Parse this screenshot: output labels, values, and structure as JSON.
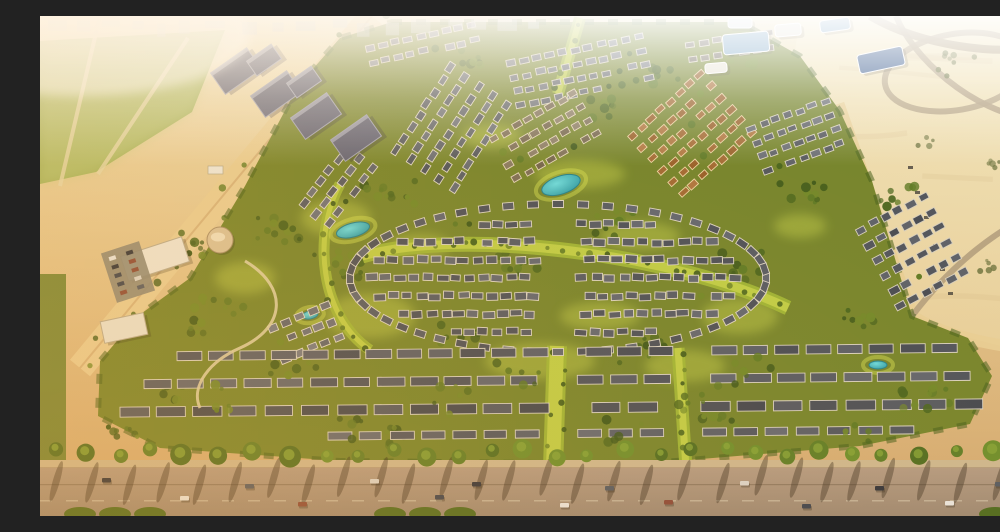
{
  "meta": {
    "description": "Golden-hour aerial rendering of a desert master-planned villa community: dense rows of white villas with dark and terracotta roofs set in green parks with turquoise ponds, a large oval villa cluster at the center, mid-rise apartment blocks and a green field to the northwest, blue glass buildings and open desert with looping sand roads to the east, and a palm-lined boulevard road with cars across the foreground."
  },
  "palette": {
    "sand_top": "#efe1b5",
    "sand_mid": "#e2c58e",
    "sand_bottom": "#d2a86f",
    "desert_light": "#f3e6bd",
    "desert_deep": "#e7d09c",
    "field_green": "#a3b45f",
    "field_light": "#c3cd81",
    "community_green": "#75852d",
    "green_dark": "#3f5a1c",
    "green_mid": "#5e7a26",
    "green_bright": "#9fb637",
    "green_highlight": "#cdd94f",
    "edge_trees": "#46601e",
    "road_top": "#b39b83",
    "road_bottom": "#9d8973",
    "sidewalk": "#cdb890",
    "sand_road": "#e8cf97",
    "desert_road": "#b3a080",
    "roof_gray": "#565b64",
    "roof_dark": "#474c55",
    "roof_brown": "#a26a34",
    "wall_white": "#ddd7c7",
    "wall_cream": "#ecd3a2",
    "apartment": "#5e6176",
    "apartment_light": "#9fa2b4",
    "glass_blue": "#7fa8c8",
    "panel_navy": "#3f5f90",
    "white_bldg": "#e9e6da",
    "pond": "#3fc3cf",
    "pond_deep": "#2a9aa6",
    "pond_rim": "#22808c",
    "shadow": "rgba(50,40,25,0.38)",
    "skyline": "#c2c8ce",
    "palm_greens": [
      "#4f6e22",
      "#5e7e28",
      "#6d8f2d"
    ],
    "tree_greens": [
      "#3f5a1c",
      "#4a661f",
      "#5e7a26",
      "#71892a"
    ],
    "desert_tree": "#6d7440",
    "car_colors": [
      "#30343c",
      "#e8e6e0",
      "#555b64",
      "#8a4a3a",
      "#d9d5cc",
      "#3d4450"
    ]
  },
  "scene": {
    "seed": 42,
    "field": {
      "poly": "0,25 185,14 152,96 56,156 0,168",
      "roads": [
        "M60,0 L20,170",
        "M148,22 L58,158"
      ],
      "buildings": [
        {
          "x": 168,
          "y": 150,
          "w": 15,
          "h": 8
        },
        {
          "x": 186,
          "y": 157,
          "w": 12,
          "h": 7
        },
        {
          "x": 204,
          "y": 150,
          "w": 10,
          "h": 6
        }
      ]
    },
    "desert_right_poly": "760,0 1000,0 1000,340 930,322 868,296 828,160 793,90 755,35",
    "left_road": {
      "d": "M332,0 L40,352",
      "w": 26
    },
    "community_poly": "352,6 700,6 760,40 800,95 832,165 872,300 928,322 952,360 930,408 820,430 600,448 300,445 120,432 58,400 60,345 98,300 150,262 205,170 258,70 300,22",
    "left_strip": {
      "x": 0,
      "y": 258,
      "w": 26,
      "h": 190
    },
    "highlights": [
      {
        "x": 330,
        "y": 300,
        "rx": 45,
        "ry": 22
      },
      {
        "x": 500,
        "y": 345,
        "rx": 55,
        "ry": 18
      },
      {
        "x": 645,
        "y": 350,
        "rx": 40,
        "ry": 16
      },
      {
        "x": 296,
        "y": 202,
        "rx": 35,
        "ry": 18
      },
      {
        "x": 540,
        "y": 158,
        "rx": 45,
        "ry": 14
      },
      {
        "x": 700,
        "y": 300,
        "rx": 38,
        "ry": 18
      },
      {
        "x": 205,
        "y": 262,
        "rx": 30,
        "ry": 16
      },
      {
        "x": 452,
        "y": 120,
        "rx": 30,
        "ry": 12
      },
      {
        "x": 600,
        "y": 220,
        "rx": 40,
        "ry": 14
      },
      {
        "x": 380,
        "y": 230,
        "rx": 30,
        "ry": 12
      },
      {
        "x": 760,
        "y": 210,
        "rx": 26,
        "ry": 12
      },
      {
        "x": 560,
        "y": 300,
        "rx": 40,
        "ry": 14
      }
    ],
    "scatter": [
      {
        "x": 350,
        "y": 180,
        "n": 12,
        "s": 26
      },
      {
        "x": 300,
        "y": 250,
        "n": 12,
        "s": 28
      },
      {
        "x": 420,
        "y": 322,
        "n": 12,
        "s": 26
      },
      {
        "x": 600,
        "y": 330,
        "n": 12,
        "s": 28
      },
      {
        "x": 700,
        "y": 250,
        "n": 12,
        "s": 26
      },
      {
        "x": 762,
        "y": 180,
        "n": 10,
        "s": 22
      },
      {
        "x": 570,
        "y": 210,
        "n": 10,
        "s": 24
      },
      {
        "x": 480,
        "y": 250,
        "n": 10,
        "s": 22
      },
      {
        "x": 240,
        "y": 212,
        "n": 12,
        "s": 24
      },
      {
        "x": 180,
        "y": 300,
        "n": 14,
        "s": 30
      },
      {
        "x": 130,
        "y": 380,
        "n": 10,
        "s": 22
      },
      {
        "x": 858,
        "y": 180,
        "n": 8,
        "s": 18
      },
      {
        "x": 820,
        "y": 300,
        "n": 8,
        "s": 18
      },
      {
        "x": 560,
        "y": 92,
        "n": 8,
        "s": 18
      },
      {
        "x": 622,
        "y": 60,
        "n": 8,
        "s": 16
      },
      {
        "x": 430,
        "y": 42,
        "n": 7,
        "s": 14
      },
      {
        "x": 700,
        "y": 42,
        "n": 7,
        "s": 14
      },
      {
        "x": 898,
        "y": 380,
        "n": 8,
        "s": 18
      },
      {
        "x": 82,
        "y": 420,
        "n": 8,
        "s": 16
      },
      {
        "x": 352,
        "y": 420,
        "n": 8,
        "s": 18
      },
      {
        "x": 680,
        "y": 402,
        "n": 8,
        "s": 18
      },
      {
        "x": 150,
        "y": 238,
        "n": 10,
        "s": 22
      }
    ],
    "fore_scatter": [
      {
        "x": 250,
        "y": 356,
        "n": 6,
        "s": 26
      },
      {
        "x": 480,
        "y": 356,
        "n": 6,
        "s": 26
      },
      {
        "x": 720,
        "y": 356,
        "n": 6,
        "s": 26
      },
      {
        "x": 180,
        "y": 384,
        "n": 6,
        "s": 26
      },
      {
        "x": 420,
        "y": 384,
        "n": 6,
        "s": 26
      },
      {
        "x": 660,
        "y": 384,
        "n": 6,
        "s": 26
      },
      {
        "x": 880,
        "y": 384,
        "n": 5,
        "s": 20
      },
      {
        "x": 320,
        "y": 412,
        "n": 5,
        "s": 24
      },
      {
        "x": 580,
        "y": 412,
        "n": 5,
        "s": 24
      },
      {
        "x": 820,
        "y": 412,
        "n": 5,
        "s": 22
      }
    ],
    "desert_scatter": [
      {
        "x": 918,
        "y": 48,
        "n": 8,
        "s": 20
      },
      {
        "x": 955,
        "y": 150,
        "n": 5,
        "s": 12
      },
      {
        "x": 885,
        "y": 125,
        "n": 4,
        "s": 10
      },
      {
        "x": 940,
        "y": 252,
        "n": 5,
        "s": 14
      },
      {
        "x": 762,
        "y": 142,
        "n": 4,
        "s": 10
      },
      {
        "x": 975,
        "y": 210,
        "n": 4,
        "s": 10
      }
    ],
    "boulevards": [
      {
        "d": "M322,240 C420,212 630,236 748,292",
        "w": 15
      },
      {
        "d": "M517,330 L513,452",
        "w": 20
      },
      {
        "d": "M638,332 L646,452",
        "w": 13
      },
      {
        "d": "M540,2 L518,78",
        "w": 12
      },
      {
        "d": "M300,168 C272,220 280,300 330,334",
        "w": 11
      }
    ],
    "ponds": [
      {
        "x": 313,
        "y": 214,
        "rx": 17,
        "ry": 7,
        "rot": -15
      },
      {
        "x": 521,
        "y": 169,
        "rx": 20,
        "ry": 9,
        "rot": -18
      },
      {
        "x": 838,
        "y": 349,
        "rx": 9,
        "ry": 4,
        "rot": 0
      },
      {
        "x": 270,
        "y": 299,
        "rx": 8,
        "ry": 4,
        "rot": -10
      }
    ],
    "clusters": [
      {
        "x": 412,
        "y": 112,
        "rot": -57,
        "rows": 5,
        "cols": 8,
        "cw": 10,
        "ch": 6.5,
        "gx": 4,
        "gy": 10.5,
        "roof": "#5a6068",
        "wall": "#ded8c8"
      },
      {
        "x": 540,
        "y": 55,
        "rot": -12,
        "rows": 4,
        "cols": 11,
        "cw": 9,
        "ch": 6,
        "gx": 4,
        "gy": 8.5,
        "roof": "#676c74",
        "wall": "#d8d2c2"
      },
      {
        "x": 505,
        "y": 120,
        "rot": -30,
        "rows": 4,
        "cols": 8,
        "cw": 9,
        "ch": 6,
        "gx": 4,
        "gy": 9,
        "roof": "#7b6e58",
        "wall": "#e2d6ba"
      },
      {
        "x": 652,
        "y": 118,
        "rot": -42,
        "rows": 6,
        "cols": 8,
        "cw": 9,
        "ch": 6,
        "gx": 4,
        "gy": 9.5,
        "roof": "#a26a34",
        "wall": "#ecd3a2"
      },
      {
        "x": 756,
        "y": 120,
        "rot": -20,
        "rows": 4,
        "cols": 7,
        "cw": 9,
        "ch": 6,
        "gx": 4,
        "gy": 9,
        "roof": "#5d6168",
        "wall": "#d9d3c3"
      },
      {
        "x": 872,
        "y": 235,
        "rot": -28,
        "rows": 6,
        "cols": 6,
        "cw": 10,
        "ch": 7,
        "gx": 4,
        "gy": 10,
        "roof": "#50555e",
        "wall": "#d6d0c0"
      },
      {
        "x": 298,
        "y": 170,
        "rot": -52,
        "rows": 3,
        "cols": 6,
        "cw": 10,
        "ch": 6.5,
        "gx": 4,
        "gy": 10,
        "roof": "#62666e",
        "wall": "#dcd6c6"
      },
      {
        "x": 266,
        "y": 316,
        "rot": -22,
        "rows": 3,
        "cols": 5,
        "cw": 10,
        "ch": 7,
        "gx": 4,
        "gy": 10,
        "roof": "#6a6e76",
        "wall": "#e0dac9"
      },
      {
        "x": 382,
        "y": 28,
        "rot": -12,
        "rows": 2,
        "cols": 9,
        "cw": 9,
        "ch": 6,
        "gx": 4,
        "gy": 9,
        "roof": "#72767e",
        "wall": "#d8d2c2"
      },
      {
        "x": 690,
        "y": 30,
        "rot": -8,
        "rows": 2,
        "cols": 7,
        "cw": 9,
        "ch": 6,
        "gx": 4,
        "gy": 9,
        "roof": "#7a7266",
        "wall": "#ddd5c2"
      }
    ],
    "oval": {
      "cx": 518,
      "cy": 262,
      "w": 11,
      "h": 7,
      "ring": {
        "rx": 208,
        "ry": 74,
        "count": 52
      },
      "rows": {
        "rx": 196,
        "ry": 66,
        "dys": [
          -54,
          -36,
          -18,
          0,
          18,
          36,
          54
        ],
        "step": 14,
        "spine": [
          498,
          536
        ]
      },
      "roof": "#565b64",
      "wall": "#dcd5c5"
    },
    "strips": {
      "skips": [
        [
          500,
          532
        ],
        [
          622,
          654
        ]
      ],
      "wall": "#d8d2c2",
      "rows": [
        {
          "x1": 150,
          "y1": 340,
          "x2": 905,
          "y2": 332,
          "h": 9,
          "seg": 26,
          "gap": 5,
          "roof": "#4f545e"
        },
        {
          "x1": 118,
          "y1": 368,
          "x2": 918,
          "y2": 360,
          "h": 9,
          "seg": 28,
          "gap": 5,
          "roof": "#565b64"
        },
        {
          "x1": 95,
          "y1": 396,
          "x2": 930,
          "y2": 388,
          "h": 10,
          "seg": 30,
          "gap": 5,
          "roof": "#4b5058"
        },
        {
          "x1": 300,
          "y1": 420,
          "x2": 862,
          "y2": 414,
          "h": 8,
          "seg": 24,
          "gap": 6,
          "roof": "#5a5f68"
        }
      ]
    },
    "clubhouse": {
      "bldgs": [
        {
          "x": 115,
          "y": 243,
          "w": 64,
          "h": 26,
          "rot": -18,
          "fill": "#ece7d8"
        },
        {
          "x": 84,
          "y": 312,
          "w": 44,
          "h": 22,
          "rot": -12,
          "fill": "#e9e4d4"
        }
      ],
      "drum": {
        "x": 180,
        "y": 224,
        "r": 13
      },
      "parking": {
        "x": 88,
        "y": 256,
        "w": 40,
        "h": 52,
        "rot": -18
      },
      "path_d": "M205,245 C250,272 245,312 200,332 C170,345 150,370 160,392"
    },
    "apartments": {
      "rot": -35,
      "blocks": [
        {
          "x": 196,
          "y": 55,
          "w": 44,
          "h": 26
        },
        {
          "x": 236,
          "y": 78,
          "w": 44,
          "h": 26
        },
        {
          "x": 276,
          "y": 100,
          "w": 44,
          "h": 26
        },
        {
          "x": 316,
          "y": 122,
          "w": 44,
          "h": 26
        },
        {
          "x": 224,
          "y": 44,
          "w": 30,
          "h": 18
        },
        {
          "x": 264,
          "y": 66,
          "w": 30,
          "h": 18
        }
      ]
    },
    "glass": [
      {
        "x": 706,
        "y": 27,
        "w": 46,
        "h": 20,
        "rot": -5,
        "fill": "#7fa8c8"
      },
      {
        "x": 748,
        "y": 14,
        "w": 26,
        "h": 12,
        "rot": -5,
        "fill": "#e6e3d8"
      },
      {
        "x": 795,
        "y": 9,
        "w": 30,
        "h": 12,
        "rot": -8,
        "fill": "#7fa8c8"
      },
      {
        "x": 841,
        "y": 44,
        "w": 46,
        "h": 19,
        "rot": -12,
        "fill": "#3f5f90"
      },
      {
        "x": 676,
        "y": 52,
        "w": 22,
        "h": 10,
        "rot": -5,
        "fill": "#e9e6da"
      },
      {
        "x": 700,
        "y": 7,
        "w": 24,
        "h": 10,
        "rot": 0,
        "fill": "#dfe3e4"
      }
    ],
    "desert_roads": [
      {
        "d": "M798,88 C820,150 850,240 872,300",
        "w": 13,
        "c": "#e8cf97"
      },
      {
        "d": "M872,300 C900,318 950,330 1000,334",
        "w": 12,
        "c": "#e8cf97"
      },
      {
        "d": "M830,0 C880,30 960,40 1000,30",
        "w": 8,
        "c": "#b3a080"
      },
      {
        "d": "M856,0 C872,40 930,96 996,104",
        "w": 6,
        "c": "#b3a080"
      },
      {
        "d": "M872,300 C910,250 960,210 1000,196",
        "w": 6,
        "c": "#b3a080"
      }
    ],
    "roundabout": {
      "cx": 916,
      "cy": 56,
      "rx": 72,
      "ry": 38,
      "rot": -10,
      "w": 6
    },
    "desert_cars": [
      {
        "x": 868,
        "y": 150
      },
      {
        "x": 875,
        "y": 175
      },
      {
        "x": 884,
        "y": 200
      },
      {
        "x": 893,
        "y": 228
      },
      {
        "x": 900,
        "y": 252
      },
      {
        "x": 908,
        "y": 276
      }
    ],
    "palms": {
      "y": 437,
      "x0": 16,
      "x1": 992,
      "step": 33
    },
    "road": {
      "sidewalk_y": 444,
      "top": 452,
      "line1": 468,
      "dash_y": 484
    },
    "cars": [
      {
        "x": 62,
        "y": 462
      },
      {
        "x": 140,
        "y": 480
      },
      {
        "x": 205,
        "y": 468
      },
      {
        "x": 258,
        "y": 486
      },
      {
        "x": 330,
        "y": 463
      },
      {
        "x": 395,
        "y": 479
      },
      {
        "x": 432,
        "y": 466
      },
      {
        "x": 520,
        "y": 487
      },
      {
        "x": 565,
        "y": 470
      },
      {
        "x": 624,
        "y": 484
      },
      {
        "x": 700,
        "y": 465
      },
      {
        "x": 762,
        "y": 488
      },
      {
        "x": 835,
        "y": 470
      },
      {
        "x": 905,
        "y": 485
      },
      {
        "x": 955,
        "y": 466
      }
    ],
    "hedges": [
      40,
      75,
      110,
      350,
      385,
      420,
      955,
      985
    ],
    "skyline": {
      "x0": 8,
      "x1": 500,
      "ymin": 2
    }
  }
}
